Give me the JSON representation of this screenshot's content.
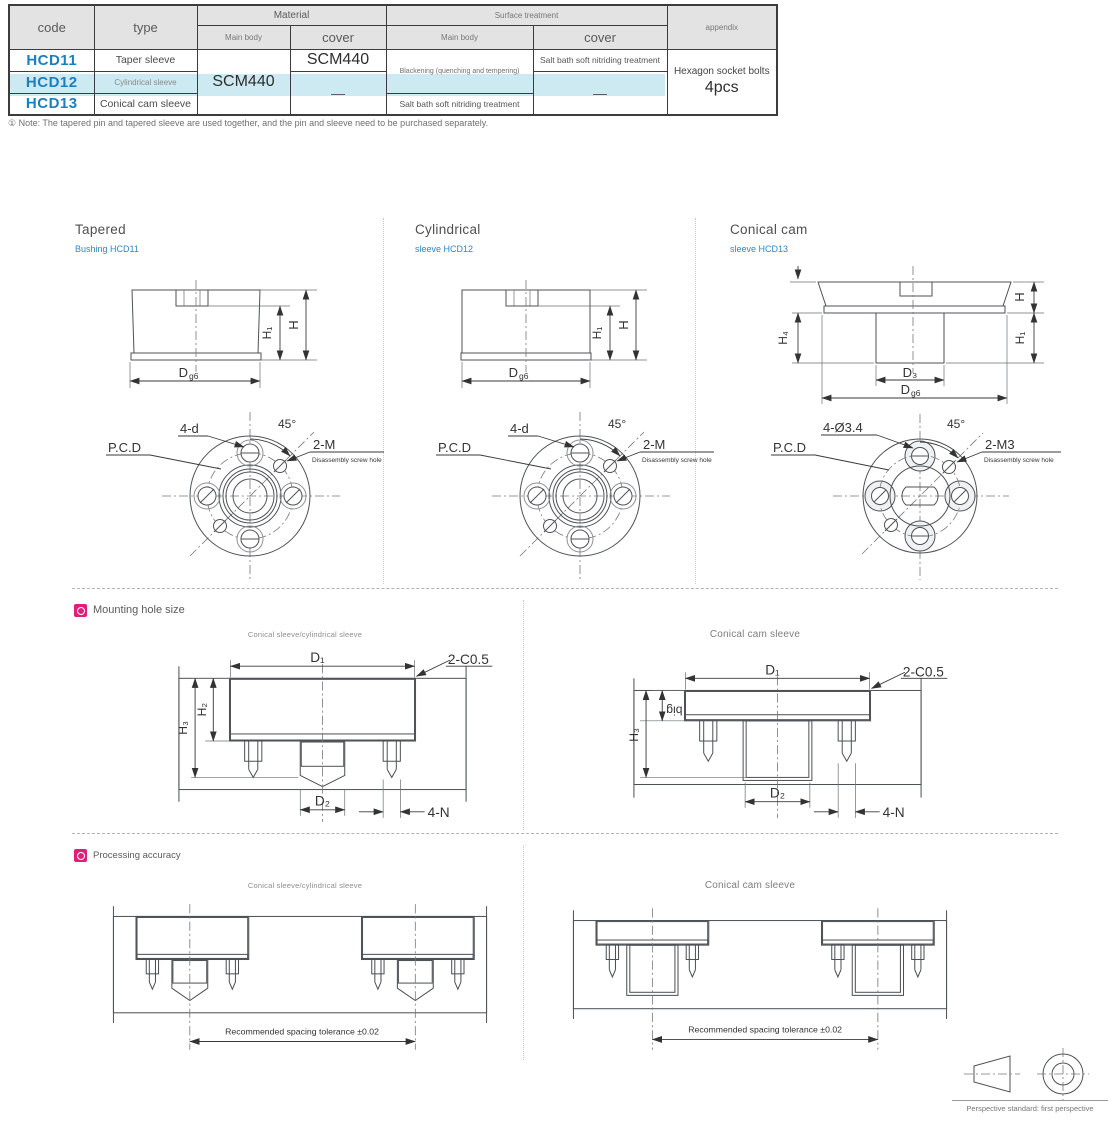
{
  "page": {
    "note": "① Note: The tapered pin and tapered sleeve are used together, and the pin and sleeve need to be purchased separately."
  },
  "table": {
    "header": {
      "code": "code",
      "type": "type",
      "material": "Material",
      "surface_treatment": "Surface treatment",
      "main_body": "Main body",
      "cover": "cover",
      "appendix": "appendix"
    },
    "rows": [
      {
        "code": "HCD11",
        "type": "Taper sleeve"
      },
      {
        "code": "HCD12",
        "type": "Cylindrical sleeve"
      },
      {
        "code": "HCD13",
        "type": "Conical cam sleeve"
      }
    ],
    "material": {
      "main_body_all": "SCM440",
      "cover_row1": "SCM440",
      "cover_rows23": "—"
    },
    "surface": {
      "main_rows12": "Blackening (quenching and tempering)",
      "main_row3": "Salt bath soft nitriding treatment",
      "cover_row1": "Salt bath soft nitriding treatment",
      "cover_rows23": "—"
    },
    "appendix": {
      "line1": "Hexagon socket bolts",
      "line2": "4pcs"
    }
  },
  "sections": [
    {
      "title": "Tapered",
      "subtitle": "Bushing HCD11"
    },
    {
      "title": "Cylindrical",
      "subtitle": "sleeve HCD12"
    },
    {
      "title": "Conical cam",
      "subtitle": "sleeve HCD13"
    }
  ],
  "dims": {
    "d": "D",
    "g6": "g6",
    "h": "H",
    "h1": "H₁",
    "h2": "H₂",
    "h3": "H₃",
    "h4": "H₄",
    "d1": "D₁",
    "d2": "D₂",
    "d3": "D₃",
    "holes": "4-d",
    "holes_cam": "4-Ø3.4",
    "angle": "45°",
    "pcd": "P.C.D",
    "screw": "2-M",
    "screw_cam": "2-M3",
    "screw_note": "Disassembly screw hole",
    "chamfer": "2-C0.5",
    "n": "4-N",
    "big": "big"
  },
  "mounting": {
    "title": "Mounting hole size",
    "label_left": "Conical sleeve/cylindrical sleeve",
    "label_right": "Conical cam sleeve"
  },
  "accuracy": {
    "title": "Processing accuracy",
    "label_left": "Conical sleeve/cylindrical sleeve",
    "label_right": "Conical cam sleeve",
    "tolerance": "Recommended spacing tolerance ±0.02"
  },
  "footer": {
    "caption": "Perspective standard: first perspective"
  },
  "colors": {
    "code_blue": "#1b80c0",
    "subtitle_blue": "#2d87c3",
    "row_highlight": "#cde9f1",
    "header_gray": "#e3e3e3",
    "accent_pink": "#e01f7a"
  }
}
